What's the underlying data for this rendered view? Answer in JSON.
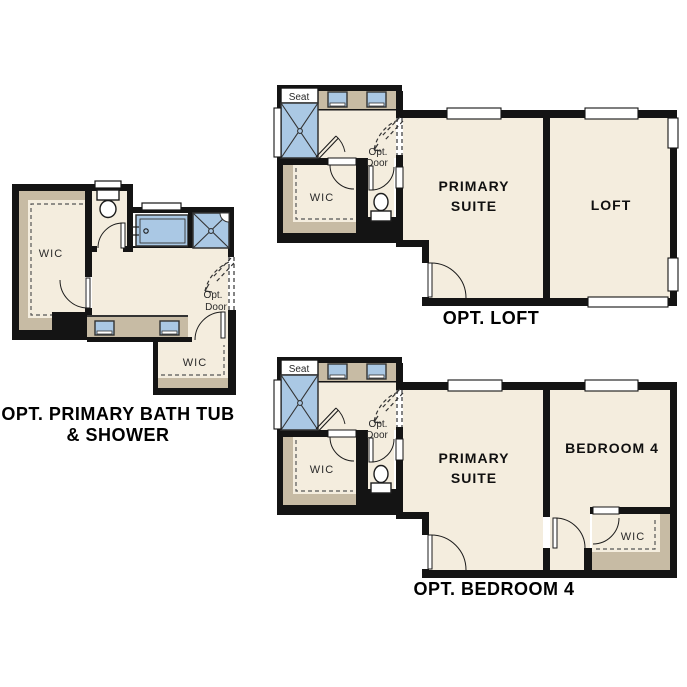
{
  "page": {
    "background": "#ffffff"
  },
  "colors": {
    "floor": "#f4edde",
    "wall": "#141414",
    "poche": "#c7bba4",
    "fixture_blue": "#aac8e4",
    "fixture_stroke": "#333333",
    "dash": "#444444"
  },
  "bath_option": {
    "caption_line1": "OPT. PRIMARY BATH TUB",
    "caption_line2": "& SHOWER",
    "wic_label": "WIC",
    "wic_lower_label": "WIC",
    "opt_door_line1": "Opt.",
    "opt_door_line2": "Door"
  },
  "shared_bath": {
    "seat_label": "Seat",
    "wic_label": "WIC",
    "opt_door_line1": "Opt.",
    "opt_door_line2": "Door"
  },
  "loft_option": {
    "caption": "OPT. LOFT",
    "primary_suite_line1": "PRIMARY",
    "primary_suite_line2": "SUITE",
    "loft_label": "LOFT"
  },
  "bedroom4_option": {
    "caption": "OPT. BEDROOM 4",
    "primary_suite_line1": "PRIMARY",
    "primary_suite_line2": "SUITE",
    "bedroom_label": "BEDROOM 4",
    "wic_label": "WIC"
  }
}
